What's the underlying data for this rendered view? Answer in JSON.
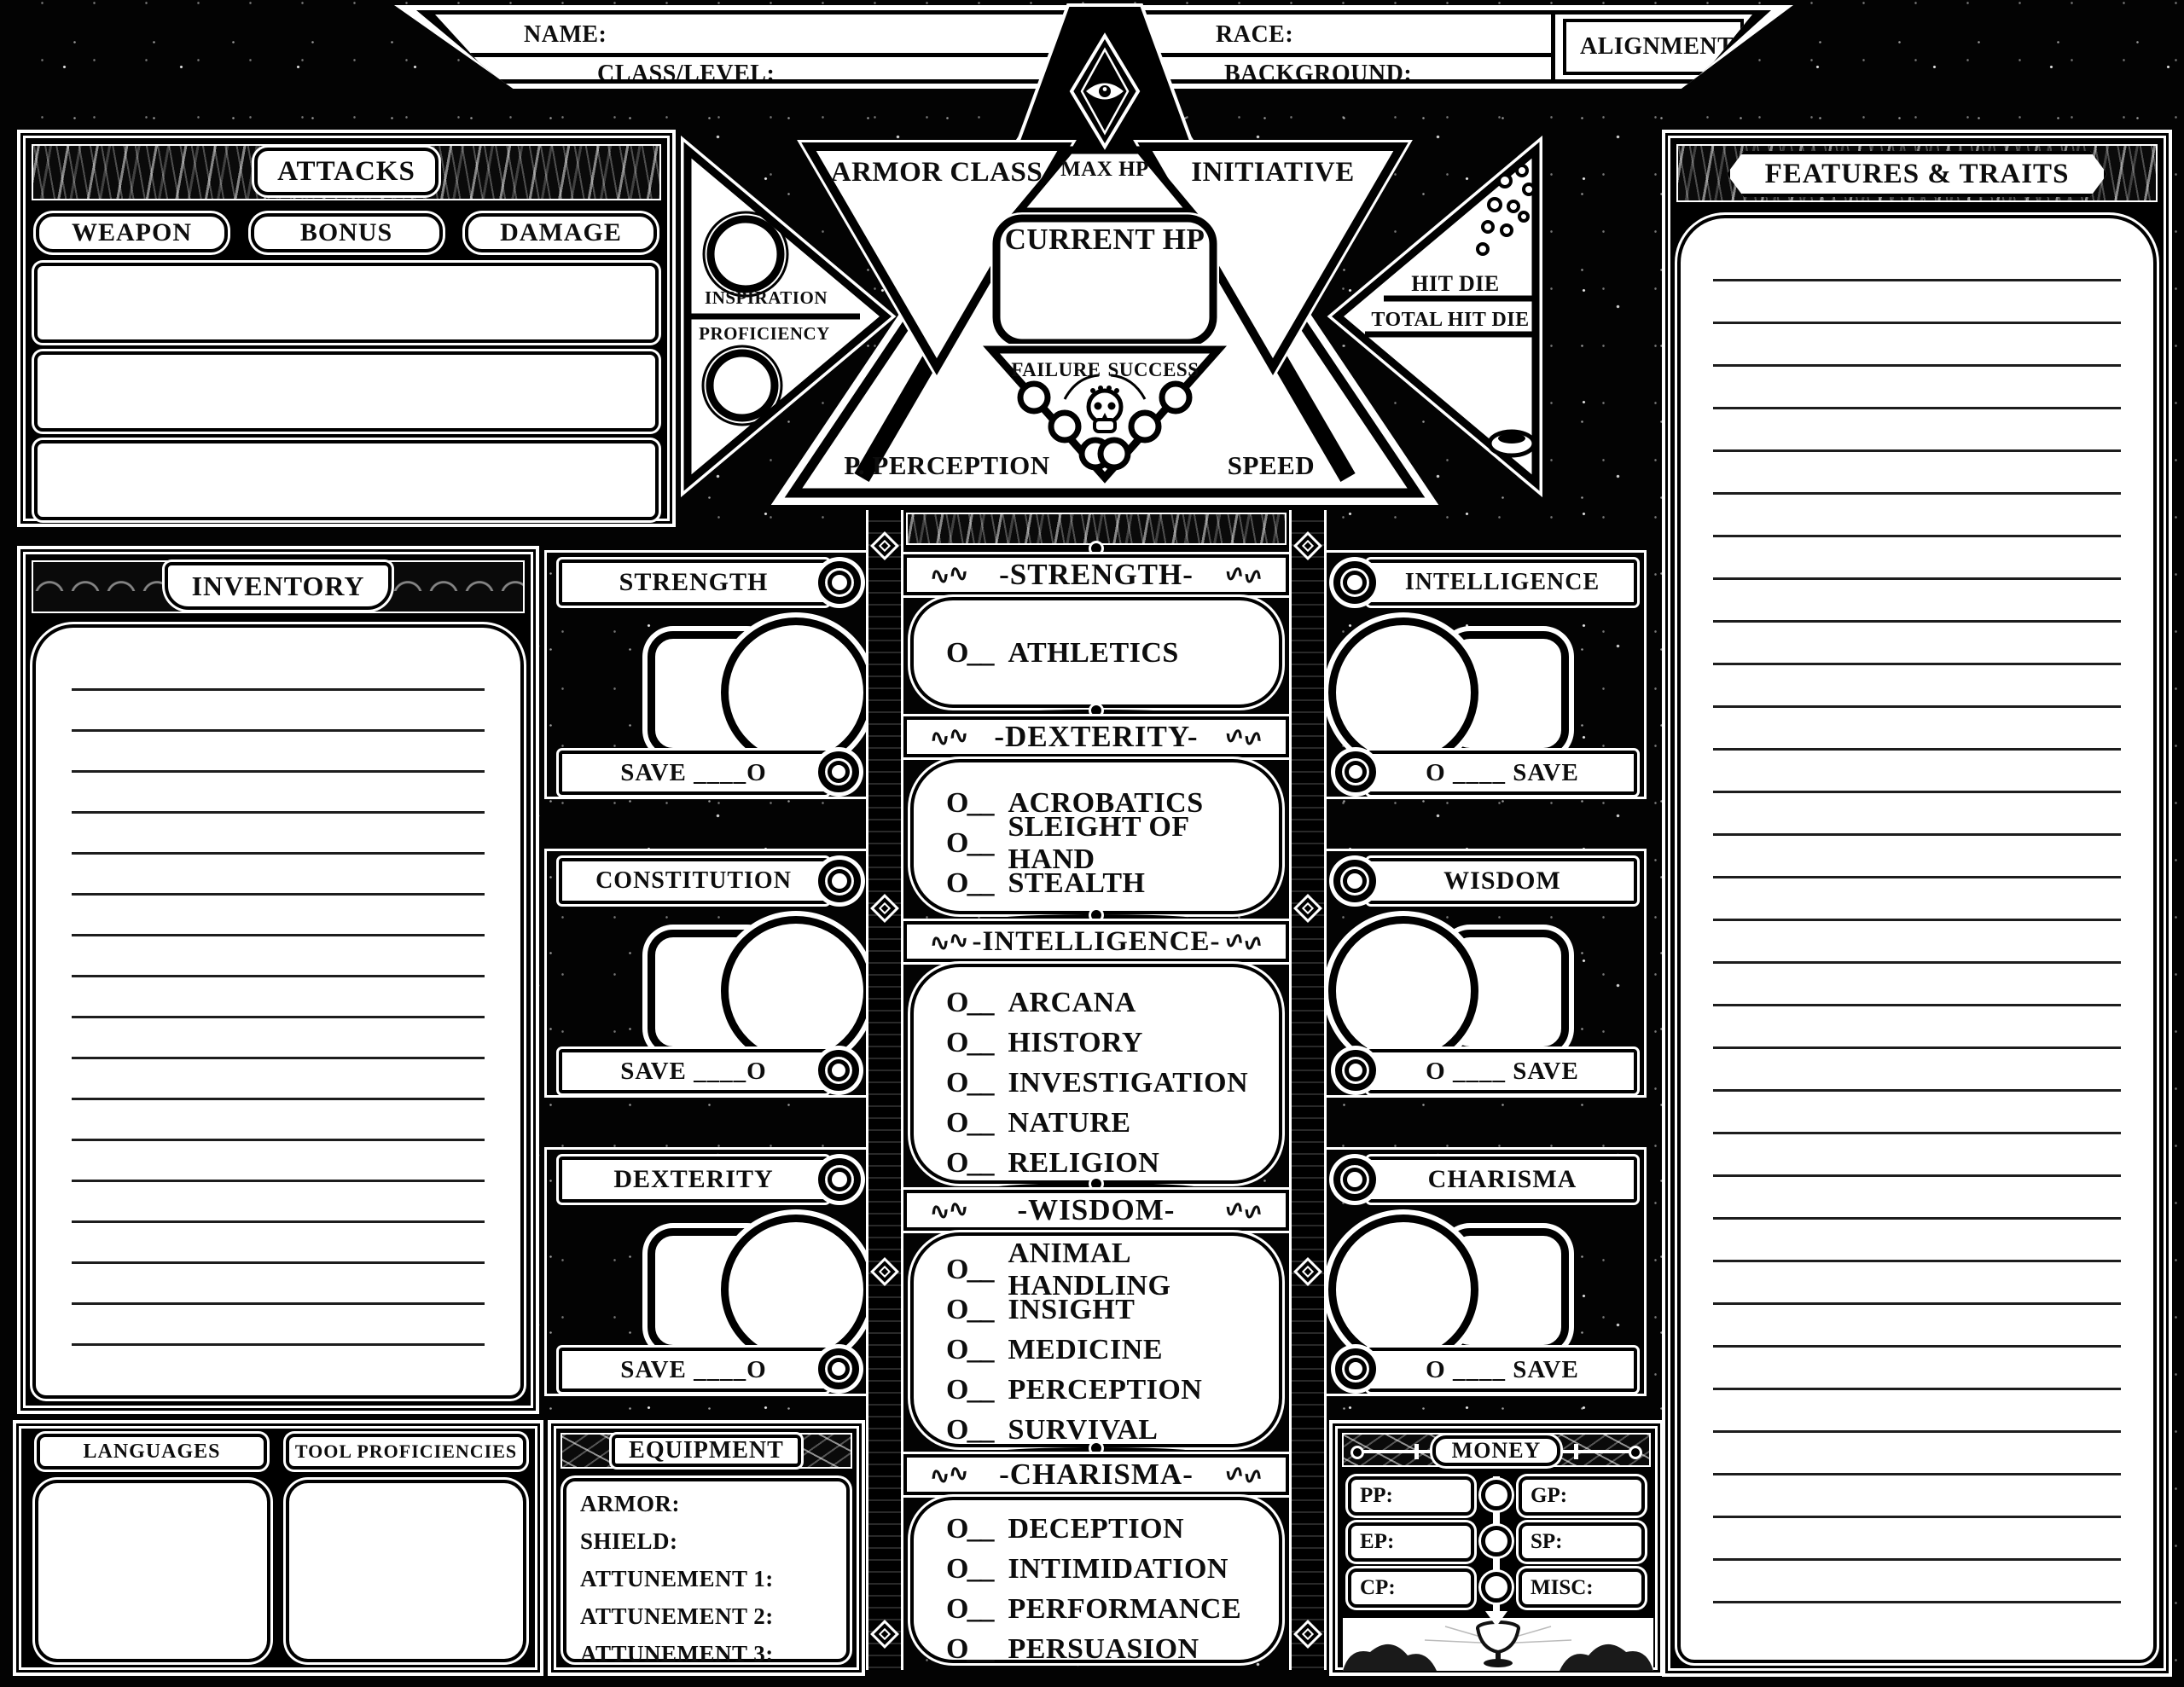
{
  "header": {
    "name_label": "NAME:",
    "class_level_label": "CLASS/LEVEL:",
    "race_label": "RACE:",
    "background_label": "BACKGROUND:",
    "alignment_label": "ALIGNMENT:"
  },
  "attacks": {
    "title": "ATTACKS",
    "columns": [
      "WEAPON",
      "BONUS",
      "DAMAGE"
    ]
  },
  "vitals": {
    "armor_class_label": "ARMOR CLASS",
    "max_hp_label": "MAX HP",
    "initiative_label": "INITIATIVE",
    "current_hp_label": "CURRENT HP",
    "inspiration_label": "INSPIRATION",
    "proficiency_label": "PROFICIENCY",
    "failure_label": "FAILURE",
    "success_label": "SUCCESS",
    "passive_perception_label": "P. PERCEPTION",
    "speed_label": "SPEED",
    "hit_die_label": "HIT DIE",
    "total_hit_die_label": "TOTAL HIT DIE"
  },
  "inventory": {
    "title": "INVENTORY"
  },
  "features": {
    "title": "FEATURES & TRAITS"
  },
  "abilities": {
    "left": [
      {
        "name": "STRENGTH",
        "save_label": "SAVE ____O"
      },
      {
        "name": "CONSTITUTION",
        "save_label": "SAVE ____O"
      },
      {
        "name": "DEXTERITY",
        "save_label": "SAVE ____O"
      }
    ],
    "right": [
      {
        "name": "INTELLIGENCE",
        "save_label": "O ____ SAVE"
      },
      {
        "name": "WISDOM",
        "save_label": "O ____ SAVE"
      },
      {
        "name": "CHARISMA",
        "save_label": "O ____ SAVE"
      }
    ]
  },
  "skills": {
    "item_prefix": "O__",
    "flourish": "∿∿",
    "groups": [
      {
        "title": "-STRENGTH-",
        "items": [
          "ATHLETICS"
        ]
      },
      {
        "title": "-DEXTERITY-",
        "items": [
          "ACROBATICS",
          "SLEIGHT OF HAND",
          "STEALTH"
        ]
      },
      {
        "title": "-INTELLIGENCE-",
        "items": [
          "ARCANA",
          "HISTORY",
          "INVESTIGATION",
          "NATURE",
          "RELIGION"
        ]
      },
      {
        "title": "-WISDOM-",
        "items": [
          "ANIMAL HANDLING",
          "INSIGHT",
          "MEDICINE",
          "PERCEPTION",
          "SURVIVAL"
        ]
      },
      {
        "title": "-CHARISMA-",
        "items": [
          "DECEPTION",
          "INTIMIDATION",
          "PERFORMANCE",
          "PERSUASION"
        ]
      }
    ]
  },
  "languages": {
    "title": "LANGUAGES"
  },
  "tools": {
    "title": "TOOL PROFICIENCIES"
  },
  "equipment": {
    "title": "EQUIPMENT",
    "fields": [
      "ARMOR:",
      "SHIELD:",
      "ATTUNEMENT 1:",
      "ATTUNEMENT 2:",
      "ATTUNEMENT 3:"
    ]
  },
  "money": {
    "title": "MONEY",
    "rows": [
      {
        "left": "PP:",
        "right": "GP:"
      },
      {
        "left": "EP:",
        "right": "SP:"
      },
      {
        "left": "CP:",
        "right": "MISC:"
      }
    ]
  },
  "colors": {
    "background": "#030303",
    "paper": "#ffffff",
    "ink": "#0d0d0d"
  }
}
